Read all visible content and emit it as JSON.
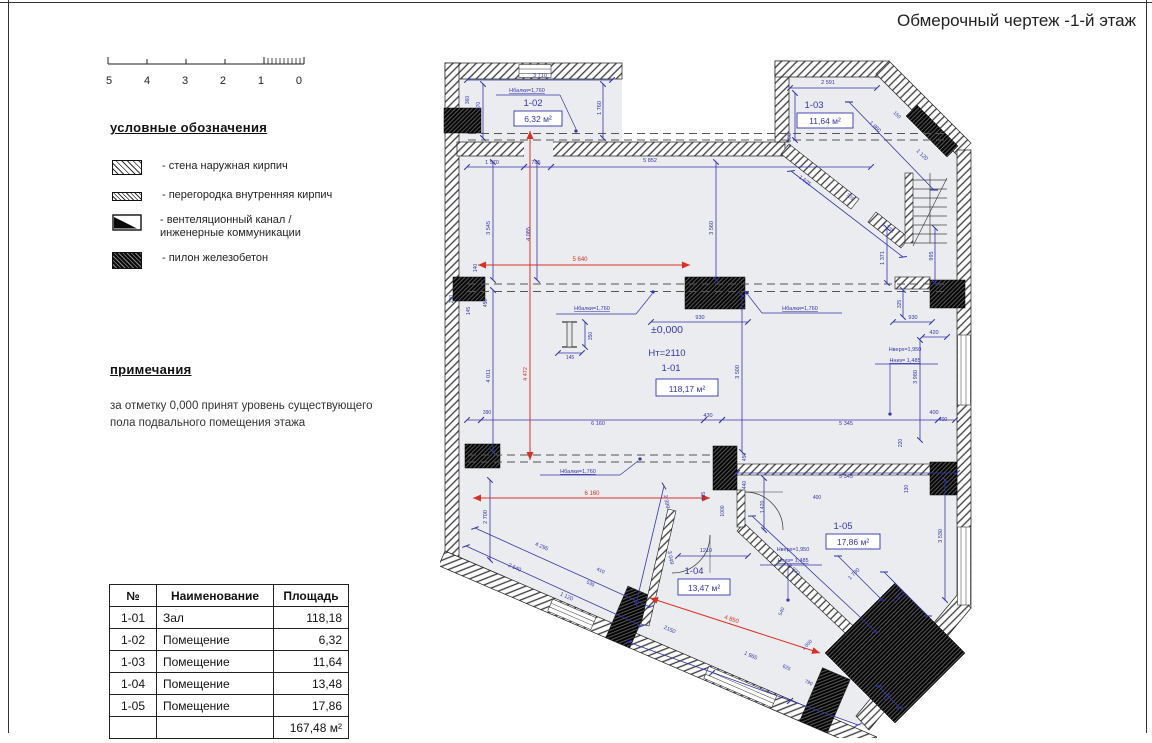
{
  "title": "Обмерочный чертеж -1-й этаж",
  "watermark": "www.lionrealestate.es",
  "scale_bar": {
    "labels": [
      "5",
      "4",
      "3",
      "2",
      "1",
      "0"
    ]
  },
  "legend": {
    "title": "условные обозначения",
    "items": [
      {
        "swatch": "exterior-brick-wall",
        "label": "- стена наружная кирпич"
      },
      {
        "swatch": "interior-brick-partition",
        "label": "- перегородка внутренняя кирпич"
      },
      {
        "swatch": "ventilation-duct",
        "label": "- вентеляционный канал / инженерные коммуникации"
      },
      {
        "swatch": "reinforced-concrete-pylon",
        "label": "- пилон железобетон"
      }
    ]
  },
  "notes": {
    "title": "примечания",
    "lines": [
      "за отметку 0,000 принят уровень существующего",
      "пола подвального помещения этажа"
    ]
  },
  "table": {
    "headers": [
      "№",
      "Наименование",
      "Площадь"
    ],
    "rows": [
      [
        "1-01",
        "Зал",
        "118,18"
      ],
      [
        "1-02",
        "Помещение",
        "6,32"
      ],
      [
        "1-03",
        "Помещение",
        "11,64"
      ],
      [
        "1-04",
        "Помещение",
        "13,48"
      ],
      [
        "1-05",
        "Помещение",
        "17,86"
      ]
    ],
    "total": "167,48 м²"
  },
  "plan": {
    "accent_blue": "#3535a8",
    "accent_red": "#d93025",
    "rooms": [
      {
        "id": "1-02",
        "area": "6,32 м²",
        "ix": 521,
        "iy": 106,
        "bx": 514,
        "by": 111,
        "bw": 48,
        "bh": 15
      },
      {
        "id": "1-03",
        "area": "11,64 м²",
        "ix": 802,
        "iy": 108,
        "bx": 797,
        "by": 113,
        "bw": 56,
        "bh": 15
      },
      {
        "id": "1-01",
        "area": "118,17 м²",
        "ix": 659,
        "iy": 371,
        "bx": 656,
        "by": 379,
        "bw": 62,
        "bh": 17
      },
      {
        "id": "1-04",
        "area": "13,47 м²",
        "ix": 682,
        "iy": 574,
        "bx": 678,
        "by": 579,
        "bw": 52,
        "bh": 16
      },
      {
        "id": "1-05",
        "area": "17,86 м²",
        "ix": 831,
        "iy": 529,
        "bx": 826,
        "by": 534,
        "bw": 54,
        "bh": 15
      }
    ],
    "annotations": [
      {
        "t": "±0,000",
        "x": 667,
        "y": 333,
        "s": 10.5
      },
      {
        "t": "Hт=2110",
        "x": 667,
        "y": 356,
        "s": 9.5
      }
    ],
    "dims": [
      {
        "t": "3 710",
        "x": 540,
        "y": 77
      },
      {
        "t": "Нбалки=1,760",
        "x": 527,
        "y": 92,
        "s": 5.5,
        "u": 1
      },
      {
        "t": "360",
        "x": 469,
        "y": 100,
        "r": -90,
        "s": 5
      },
      {
        "t": "970",
        "x": 480,
        "y": 106,
        "r": -90,
        "s": 5
      },
      {
        "t": "1 760",
        "x": 601,
        "y": 108,
        "r": -90,
        "s": 5.5
      },
      {
        "t": "1 570",
        "x": 492,
        "y": 164,
        "s": 5.5
      },
      {
        "t": "705",
        "x": 536,
        "y": 164,
        "s": 5.5
      },
      {
        "t": "5 852",
        "x": 650,
        "y": 162,
        "s": 5.5
      },
      {
        "t": "2 591",
        "x": 828,
        "y": 84,
        "s": 5.5
      },
      {
        "t": "1 906",
        "x": 791,
        "y": 140,
        "r": -90,
        "s": 5.5
      },
      {
        "t": "1 860",
        "x": 874,
        "y": 128,
        "r": 43,
        "s": 5.5
      },
      {
        "t": "150",
        "x": 896,
        "y": 116,
        "r": 43,
        "s": 5
      },
      {
        "t": "1 120",
        "x": 921,
        "y": 156,
        "r": 43,
        "s": 5.5
      },
      {
        "t": "1 625",
        "x": 804,
        "y": 182,
        "r": 37,
        "s": 5.5
      },
      {
        "t": "705",
        "x": 849,
        "y": 198,
        "r": 37,
        "s": 5
      },
      {
        "t": "1 733",
        "x": 887,
        "y": 229,
        "r": 37,
        "s": 5.5
      },
      {
        "t": "1 371",
        "x": 884,
        "y": 258,
        "r": -90,
        "s": 5.5
      },
      {
        "t": "995",
        "x": 933,
        "y": 256,
        "r": -90,
        "s": 5.5
      },
      {
        "t": "325",
        "x": 901,
        "y": 304,
        "r": -90,
        "s": 5
      },
      {
        "t": "930",
        "x": 913,
        "y": 319,
        "s": 5.5
      },
      {
        "t": "420",
        "x": 934,
        "y": 334,
        "s": 5.5
      },
      {
        "t": "5 640",
        "x": 580,
        "y": 261,
        "red": 1,
        "s": 6
      },
      {
        "t": "140",
        "x": 477,
        "y": 268,
        "r": -90,
        "s": 5
      },
      {
        "t": "290",
        "x": 453,
        "y": 299,
        "r": -90,
        "s": 5
      },
      {
        "t": "145",
        "x": 470,
        "y": 311,
        "r": -90,
        "s": 5
      },
      {
        "t": "450",
        "x": 487,
        "y": 303,
        "r": -90,
        "s": 5
      },
      {
        "t": "3 545",
        "x": 490,
        "y": 228,
        "r": -90,
        "s": 5.5
      },
      {
        "t": "4 085",
        "x": 530,
        "y": 234,
        "r": -90,
        "s": 5.5
      },
      {
        "t": "4 011",
        "x": 490,
        "y": 376,
        "r": -90,
        "s": 5.5
      },
      {
        "t": "4 472",
        "x": 527,
        "y": 374,
        "r": -90,
        "red": 1,
        "s": 5.5
      },
      {
        "t": "3 560",
        "x": 713,
        "y": 228,
        "r": -90,
        "s": 5.5
      },
      {
        "t": "Нбалки=1,760",
        "x": 592,
        "y": 310,
        "s": 5.5,
        "u": 1
      },
      {
        "t": "350",
        "x": 592,
        "y": 336,
        "r": -90,
        "s": 5
      },
      {
        "t": "145",
        "x": 570,
        "y": 359,
        "s": 5
      },
      {
        "t": "930",
        "x": 700,
        "y": 319,
        "s": 5.5
      },
      {
        "t": "Нбалки=1,760",
        "x": 800,
        "y": 310,
        "s": 5.5,
        "u": 1
      },
      {
        "t": "3 500",
        "x": 739,
        "y": 372,
        "r": -90,
        "s": 5.5
      },
      {
        "t": "Нверх=1,950",
        "x": 905,
        "y": 351,
        "s": 5.5
      },
      {
        "t": "Нниз= 1,485",
        "x": 905,
        "y": 362,
        "s": 5.5,
        "u": 1
      },
      {
        "t": "3 980",
        "x": 917,
        "y": 377,
        "r": -90,
        "s": 5.5
      },
      {
        "t": "400",
        "x": 934,
        "y": 414,
        "s": 5.5
      },
      {
        "t": "220",
        "x": 902,
        "y": 443,
        "r": -90,
        "s": 5
      },
      {
        "t": "390",
        "x": 487,
        "y": 414,
        "s": 5
      },
      {
        "t": "6 160",
        "x": 598,
        "y": 425,
        "s": 5.5
      },
      {
        "t": "430",
        "x": 708,
        "y": 417,
        "s": 5.5
      },
      {
        "t": "5 345",
        "x": 846,
        "y": 425,
        "s": 5.5
      },
      {
        "t": "400",
        "x": 943,
        "y": 421,
        "s": 5
      },
      {
        "t": "Нбалки=1,760",
        "x": 578,
        "y": 473,
        "s": 5.5,
        "u": 1
      },
      {
        "t": "6 160",
        "x": 592,
        "y": 495,
        "red": 1,
        "s": 6
      },
      {
        "t": "5 345",
        "x": 846,
        "y": 478,
        "s": 5.5
      },
      {
        "t": "130",
        "x": 908,
        "y": 489,
        "r": -90,
        "s": 5
      },
      {
        "t": "2 700",
        "x": 487,
        "y": 517,
        "r": -90,
        "s": 5.5
      },
      {
        "t": "450",
        "x": 746,
        "y": 457,
        "r": -90,
        "s": 5
      },
      {
        "t": "440",
        "x": 746,
        "y": 485,
        "r": -90,
        "s": 5
      },
      {
        "t": "365",
        "x": 705,
        "y": 496,
        "r": -90,
        "s": 5
      },
      {
        "t": "1000",
        "x": 724,
        "y": 511,
        "r": -90,
        "s": 5
      },
      {
        "t": "1 420",
        "x": 764,
        "y": 507,
        "r": -90,
        "s": 5
      },
      {
        "t": "1210",
        "x": 706,
        "y": 552,
        "s": 5.5
      },
      {
        "t": "Нверх=1,950",
        "x": 793,
        "y": 551,
        "s": 5.5
      },
      {
        "t": "Нниз= 1,485",
        "x": 793,
        "y": 562,
        "s": 5.5,
        "u": 1
      },
      {
        "t": "3 530",
        "x": 942,
        "y": 536,
        "r": -90,
        "s": 5.5
      },
      {
        "t": "400",
        "x": 817,
        "y": 499,
        "s": 5
      },
      {
        "t": "2 399",
        "x": 665,
        "y": 502,
        "r": 78,
        "s": 5.5
      },
      {
        "t": "3 049",
        "x": 669,
        "y": 558,
        "r": 78,
        "s": 5.5
      },
      {
        "t": "4 295",
        "x": 541,
        "y": 548,
        "r": 24,
        "s": 5.5
      },
      {
        "t": "2 640",
        "x": 514,
        "y": 569,
        "r": 24,
        "s": 5.5
      },
      {
        "t": "1 120",
        "x": 566,
        "y": 598,
        "r": 24,
        "s": 5.5
      },
      {
        "t": "535",
        "x": 590,
        "y": 585,
        "r": 24,
        "s": 5
      },
      {
        "t": "410",
        "x": 600,
        "y": 572,
        "r": 24,
        "s": 5
      },
      {
        "t": "3 933",
        "x": 793,
        "y": 571,
        "r": 43,
        "s": 5.5
      },
      {
        "t": "2150",
        "x": 669,
        "y": 631,
        "r": 24,
        "s": 5.5
      },
      {
        "t": "4 850",
        "x": 731,
        "y": 621,
        "r": 18,
        "red": 1,
        "s": 6
      },
      {
        "t": "1 965",
        "x": 750,
        "y": 657,
        "r": 24,
        "s": 5.5
      },
      {
        "t": "625",
        "x": 786,
        "y": 669,
        "r": 24,
        "s": 5
      },
      {
        "t": "790",
        "x": 808,
        "y": 684,
        "r": 24,
        "s": 5
      },
      {
        "t": "540",
        "x": 783,
        "y": 612,
        "r": -68,
        "s": 5
      },
      {
        "t": "1 000",
        "x": 808,
        "y": 646,
        "r": -45,
        "s": 5
      },
      {
        "t": "1 780",
        "x": 855,
        "y": 575,
        "r": -45,
        "s": 5.5
      },
      {
        "t": "1 802",
        "x": 900,
        "y": 599,
        "r": -45,
        "s": 5.5
      },
      {
        "t": "476",
        "x": 888,
        "y": 698,
        "r": -45,
        "s": 5
      }
    ]
  }
}
